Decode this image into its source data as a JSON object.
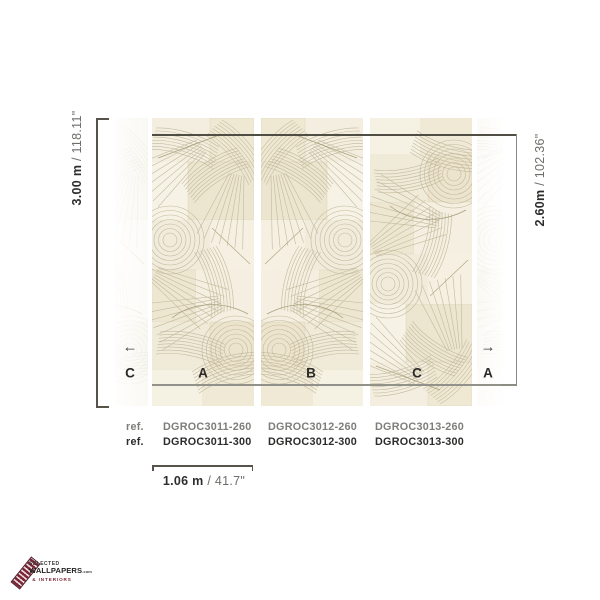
{
  "diagram": {
    "letters": [
      "C",
      "A",
      "B",
      "C",
      "A"
    ],
    "arrow_left": "←",
    "arrow_right": "→"
  },
  "dimensions": {
    "total_height": {
      "metric": "3.00 m",
      "imperial": "/ 118.11\""
    },
    "panel_height": {
      "metric": "2.60m",
      "imperial": "/ 102.36\""
    },
    "panel_width": {
      "metric": "1.06 m",
      "imperial": "/ 41.7\""
    }
  },
  "refs": {
    "rows": [
      {
        "label": "ref.",
        "codes": [
          "DGROC3011-260",
          "DGROC3012-260",
          "DGROC3013-260"
        ]
      },
      {
        "label": "ref.",
        "codes": [
          "DGROC3011-300",
          "DGROC3012-300",
          "DGROC3013-300"
        ]
      }
    ]
  },
  "logo": {
    "top": "SELECTED",
    "main": "WALLPAPERS",
    "suffix": ".com",
    "sub": "& INTERIORS"
  },
  "colors": {
    "accent_maroon": "#7c2536",
    "bracket_dark": "#55534a",
    "bracket_gray": "#8c8c85",
    "text_dark": "#2d2c2a",
    "text_gray": "#7e7d7a",
    "wallpaper_cream": "#f1ebdb"
  }
}
